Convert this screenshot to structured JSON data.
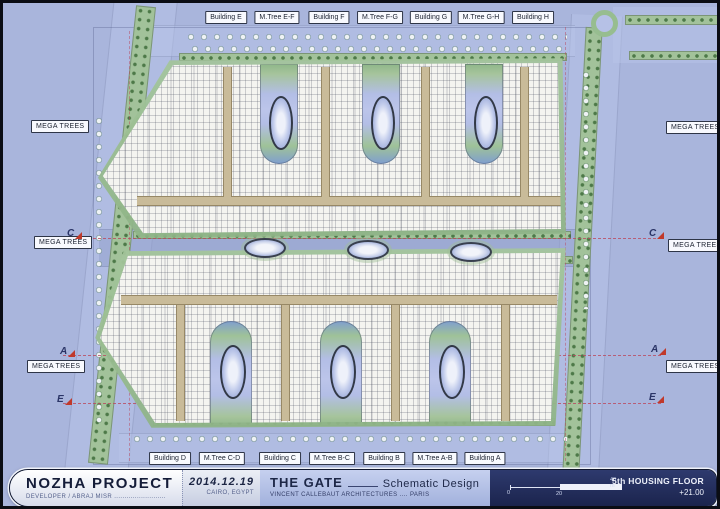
{
  "plan": {
    "top_labels": [
      "Building E",
      "M.Tree E-F",
      "Building F",
      "M.Tree F-G",
      "Building G",
      "M.Tree G-H",
      "Building H"
    ],
    "bottom_labels": [
      "Building D",
      "M.Tree C-D",
      "Building C",
      "M.Tree B-C",
      "Building B",
      "M.Tree A-B",
      "Building A"
    ],
    "mega_trees_label": "MEGA TREES",
    "section_markers": {
      "c": "C",
      "a": "A",
      "e": "E"
    }
  },
  "title_block": {
    "project_name": "NOZHA PROJECT",
    "developer_line": "DEVELOPER / ABRAJ MISR .........................",
    "date": "2014.12.19",
    "location": "CAIRO, EGYPT",
    "drawing_title": "THE GATE",
    "phase": "Schematic Design",
    "architect_line": "VINCENT CALLEBAUT ARCHITECTURES .... PARIS",
    "sheet_label": "5th HOUSING FLOOR",
    "elevation": "+21.00",
    "scale_ticks": {
      "zero": "0",
      "mid": "20",
      "end": "40 m"
    }
  },
  "colors": {
    "background": "#a9b5dc",
    "building_fill": "#f4f4f0",
    "greenery": "#9fc298",
    "corridor": "#c9bb99",
    "title_navy": "#222d5c",
    "survey_dash": "#ba485e"
  }
}
